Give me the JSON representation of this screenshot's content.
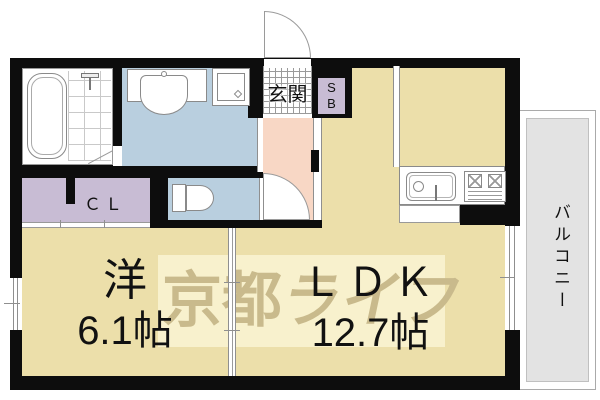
{
  "floorplan": {
    "title": "apartment-floorplan-1ldk",
    "watermark": {
      "part_regular": "京都",
      "part_italic": "ライフ"
    },
    "rooms": {
      "entrance": {
        "label": "玄関"
      },
      "shoe_box": {
        "label": "SB"
      },
      "closet": {
        "label": "ＣＬ"
      },
      "western_room": {
        "name": "洋",
        "size": "6.1帖"
      },
      "ldk": {
        "name": "ＬＤＫ",
        "size": "12.7帖"
      },
      "balcony": {
        "label": "バルコニー"
      }
    },
    "fixtures": [
      "bathtub",
      "shower-fixture",
      "washbasin",
      "washing-machine-pan",
      "toilet",
      "kitchen-sink",
      "gas-stove",
      "entrance-door",
      "toilet-door",
      "bathroom-door",
      "window",
      "balcony-sliding-door",
      "room-sliding-partition"
    ],
    "colors": {
      "wall": "#0d0d0d",
      "room_tan": "#ecdfaa",
      "wet_area_blue": "#b9cfdf",
      "hallway_pink": "#f8d7c5",
      "closet_lavender": "#c8bcd4",
      "balcony_gray": "#e3e3e3",
      "watermark_text": "#c9ba8c",
      "watermark_band": "#faf4d4"
    }
  }
}
